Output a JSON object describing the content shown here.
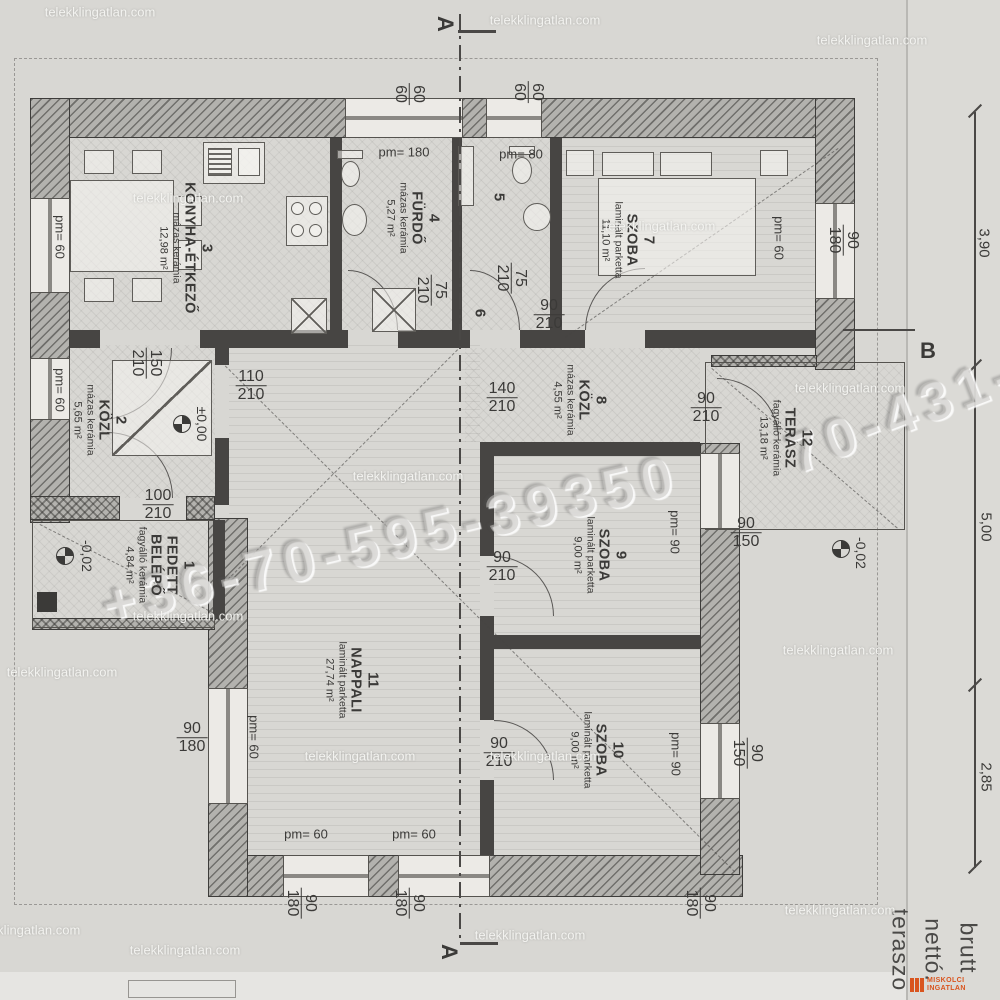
{
  "watermark": {
    "site": "telekklingatlan.com",
    "phone_main": "+36-70-595-39350",
    "phone_right": "70-431-6"
  },
  "sections": {
    "a": "A",
    "b": "B"
  },
  "corner_words": [
    "brutt",
    "nettó.",
    "teraszo"
  ],
  "logo": {
    "line1": "MISKOLCI",
    "line2": "INGATLAN"
  },
  "rooms": [
    {
      "num": "1",
      "name": "FEDETT",
      "name2": "BELÉPŐ",
      "finish": "fagyálló kerámia",
      "area": "4,84 m²",
      "x": 160,
      "y": 565
    },
    {
      "num": "2",
      "name": "KÖZL",
      "name2": "",
      "finish": "mázas kerámia",
      "area": "5,65 m²",
      "x": 100,
      "y": 420
    },
    {
      "num": "3",
      "name": "KONYHA-ÉTKEZŐ",
      "name2": "",
      "finish": "mázas kerámia",
      "area": "12,98 m²",
      "x": 186,
      "y": 248
    },
    {
      "num": "4",
      "name": "FÜRDŐ",
      "name2": "",
      "finish": "mázas kerámia",
      "area": "5,27 m²",
      "x": 413,
      "y": 218
    },
    {
      "num": "5",
      "name": "",
      "name2": "",
      "finish": "",
      "area": "",
      "x": 498,
      "y": 197
    },
    {
      "num": "6",
      "name": "",
      "name2": "",
      "finish": "",
      "area": "",
      "x": 479,
      "y": 313
    },
    {
      "num": "7",
      "name": "SZOBA",
      "name2": "",
      "finish": "laminált parketta",
      "area": "11,10 m²",
      "x": 628,
      "y": 240
    },
    {
      "num": "8",
      "name": "KÖZL",
      "name2": "",
      "finish": "mázas kerámia",
      "area": "4,55 m²",
      "x": 580,
      "y": 400
    },
    {
      "num": "9",
      "name": "SZOBA",
      "name2": "",
      "finish": "laminált parketta",
      "area": "9,00 m²",
      "x": 600,
      "y": 555
    },
    {
      "num": "10",
      "name": "SZOBA",
      "name2": "",
      "finish": "laminált parketta",
      "area": "9,00 m²",
      "x": 597,
      "y": 750
    },
    {
      "num": "11",
      "name": "NAPPALI",
      "name2": "",
      "finish": "laminált parketta",
      "area": "27,74 m²",
      "x": 352,
      "y": 680
    },
    {
      "num": "12",
      "name": "TERASZ",
      "name2": "",
      "finish": "fagyálló kerámia",
      "area": "13,18 m²",
      "x": 786,
      "y": 438
    }
  ],
  "dim_pairs": [
    {
      "top": "90",
      "bottom": "210",
      "x": 706,
      "y": 408,
      "rot": 0
    },
    {
      "top": "140",
      "bottom": "210",
      "x": 502,
      "y": 398,
      "rot": 0
    },
    {
      "top": "110",
      "bottom": "210",
      "x": 251,
      "y": 386,
      "rot": 0
    },
    {
      "top": "150",
      "bottom": "210",
      "x": 146,
      "y": 363,
      "rot": 90
    },
    {
      "top": "100",
      "bottom": "210",
      "x": 158,
      "y": 505,
      "rot": 0
    },
    {
      "top": "90",
      "bottom": "210",
      "x": 502,
      "y": 567,
      "rot": 0
    },
    {
      "top": "90",
      "bottom": "210",
      "x": 499,
      "y": 753,
      "rot": 0
    },
    {
      "top": "90",
      "bottom": "210",
      "x": 549,
      "y": 315,
      "rot": 0
    },
    {
      "top": "75",
      "bottom": "210",
      "x": 431,
      "y": 290,
      "rot": 90
    },
    {
      "top": "75",
      "bottom": "210",
      "x": 511,
      "y": 278,
      "rot": 90
    },
    {
      "top": "90",
      "bottom": "180",
      "x": 843,
      "y": 240,
      "rot": 90
    },
    {
      "top": "90",
      "bottom": "150",
      "x": 746,
      "y": 533,
      "rot": 0
    },
    {
      "top": "90",
      "bottom": "150",
      "x": 747,
      "y": 753,
      "rot": 90
    },
    {
      "top": "90",
      "bottom": "180",
      "x": 192,
      "y": 738,
      "rot": 0
    },
    {
      "top": "60",
      "bottom": "60",
      "x": 409,
      "y": 94,
      "rot": 90
    },
    {
      "top": "60",
      "bottom": "60",
      "x": 528,
      "y": 92,
      "rot": 90
    },
    {
      "top": "90",
      "bottom": "180",
      "x": 301,
      "y": 903,
      "rot": 90
    },
    {
      "top": "90",
      "bottom": "180",
      "x": 409,
      "y": 903,
      "rot": 90
    },
    {
      "top": "90",
      "bottom": "180",
      "x": 700,
      "y": 903,
      "rot": 90
    }
  ],
  "pm_labels": [
    {
      "text": "pm= 180",
      "x": 404,
      "y": 152,
      "rot": 0
    },
    {
      "text": "pm= 80",
      "x": 521,
      "y": 154,
      "rot": 0
    },
    {
      "text": "pm= 60",
      "x": 60,
      "y": 237,
      "rot": 90
    },
    {
      "text": "pm= 60",
      "x": 60,
      "y": 390,
      "rot": 90
    },
    {
      "text": "pm= 60",
      "x": 779,
      "y": 238,
      "rot": 90
    },
    {
      "text": "pm= 60",
      "x": 254,
      "y": 737,
      "rot": 90
    },
    {
      "text": "pm= 60",
      "x": 306,
      "y": 834,
      "rot": 0
    },
    {
      "text": "pm= 60",
      "x": 414,
      "y": 834,
      "rot": 0
    },
    {
      "text": "pm= 90",
      "x": 676,
      "y": 754,
      "rot": 90
    },
    {
      "text": "pm= 90",
      "x": 675,
      "y": 532,
      "rot": 90
    }
  ],
  "levels": [
    {
      "text": "±0,00",
      "x": 202,
      "y": 424,
      "sx": 182,
      "sy": 424
    },
    {
      "text": "-0,02",
      "x": 87,
      "y": 556,
      "sx": 65,
      "sy": 556
    },
    {
      "text": "-0,02",
      "x": 861,
      "y": 553,
      "sx": 841,
      "sy": 549
    }
  ],
  "chain": {
    "values": [
      "3,90",
      "5,00",
      "2,85"
    ]
  },
  "site_tiles": [
    [
      100,
      12
    ],
    [
      545,
      20
    ],
    [
      872,
      40
    ],
    [
      188,
      198
    ],
    [
      660,
      226
    ],
    [
      850,
      388
    ],
    [
      408,
      476
    ],
    [
      188,
      616
    ],
    [
      62,
      672
    ],
    [
      838,
      650
    ],
    [
      360,
      756
    ],
    [
      545,
      756
    ],
    [
      25,
      930
    ],
    [
      530,
      935
    ],
    [
      840,
      910
    ],
    [
      185,
      950
    ]
  ]
}
